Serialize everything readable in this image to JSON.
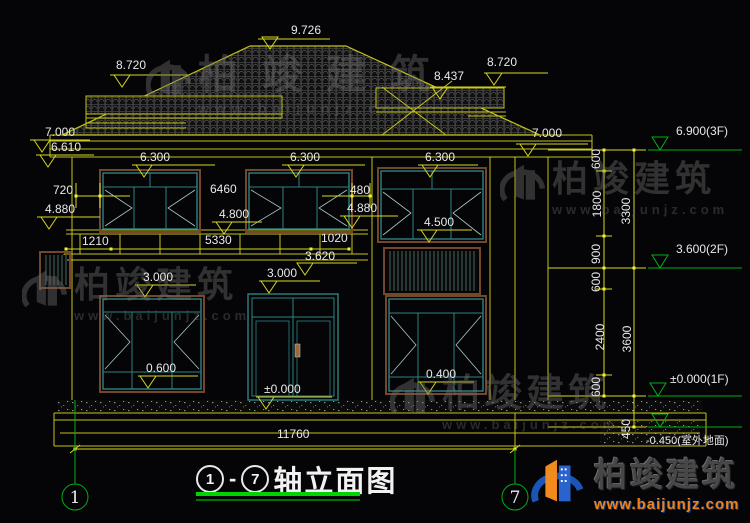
{
  "drawing": {
    "title": {
      "axis_start": "1",
      "separator": "-",
      "axis_end": "7",
      "text": "轴立面图"
    },
    "axis_bubbles": {
      "left": "1",
      "right": "7"
    },
    "elevation_marks": {
      "ridge": "9.726",
      "dormer_left": "8.720",
      "dormer_right_low": "8.437",
      "dormer_right_high": "8.720",
      "eave_left_upper": "7.000",
      "eave_left_lower": "6.610",
      "eave_right": "7.000",
      "floor2_head_left": "6.300",
      "floor2_head_mid": "6.300",
      "floor2_head_right": "6.300",
      "floor2_sill_left": "4.880",
      "floor2_sill_mid": "4.800",
      "floor2_sill_right": "4.880",
      "tower_window_sill": "4.500",
      "balcony_level": "3.620",
      "floor1_head_left": "3.000",
      "floor1_head_right": "3.000",
      "window1_left_sill": "0.600",
      "entry_door_level": "±0.000",
      "window1_right_sill": "0.400"
    },
    "width_dims": {
      "w2_left": "720",
      "w2_mid": "6460",
      "w2_right": "480",
      "balcony_left": "1210",
      "balcony_mid": "5330",
      "balcony_right": "1020",
      "total": "11760"
    },
    "right_axis": {
      "levels": {
        "f3": "6.900(3F)",
        "f2": "3.600(2F)",
        "f1": "±0.000(1F)",
        "ground": "-0.450(室外地面)"
      },
      "segments": {
        "s600a": "600",
        "s1800": "1800",
        "s900": "900",
        "s600b": "600",
        "s2400": "2400",
        "s600c": "600",
        "s450": "450",
        "total_upper": "3300",
        "total_lower": "3600"
      }
    }
  },
  "watermark": {
    "brand": "柏竣建筑",
    "site": "www.baijunjz.com"
  },
  "logo": {
    "brand": "柏竣建筑",
    "site": "www.baijunjz.com"
  },
  "colors": {
    "background": "#050507",
    "line_yellow": "#c3c31a",
    "dim_yellow": "#d6d61e",
    "dim_text": "#e9e9e9",
    "axis_green": "#00b014",
    "underline_green": "#00d400",
    "window_teal": "#2e8282",
    "frame_brown": "#74462a",
    "logo_orange": "#f08018",
    "logo_blue": "#1a56b8"
  }
}
